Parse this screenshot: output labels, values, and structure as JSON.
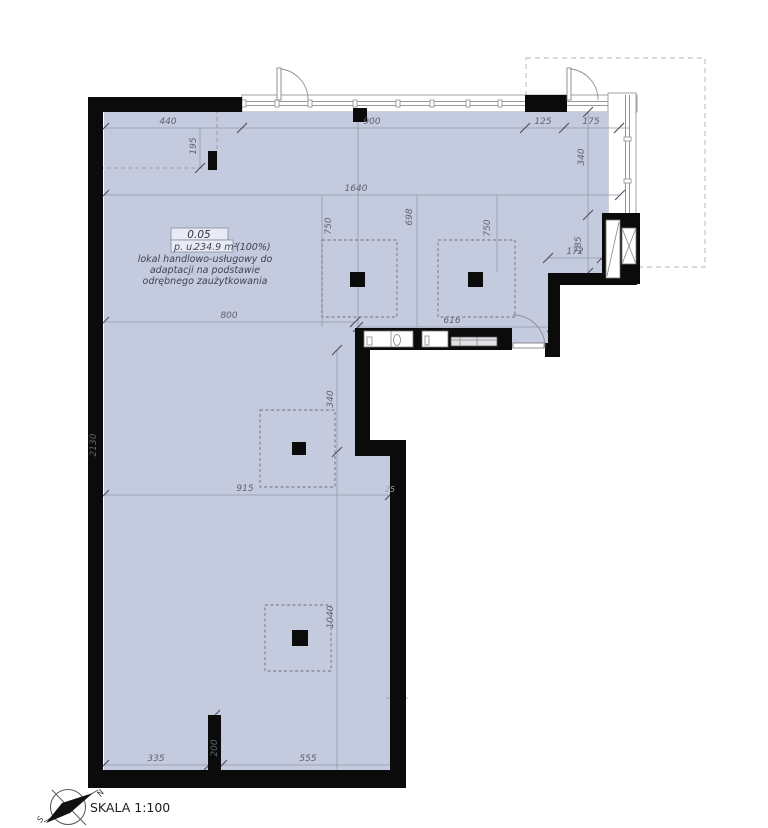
{
  "meta": {
    "scale_label": "SKALA 1:100"
  },
  "compass": {
    "north_label": "N",
    "south_label": "S"
  },
  "room_label": {
    "number": "0.05",
    "area_prefix": "p. u.",
    "area_value": "234.9 m²",
    "area_percent": "(100%)",
    "description_lines": [
      "lokal handlowo-usługowy do",
      "adaptacji na podstawie",
      "odrębnego zaużytkowania"
    ]
  },
  "dimensions": {
    "d440": "440",
    "d900": "900",
    "d125": "125",
    "d175": "175",
    "d195": "195",
    "d1640": "1640",
    "d750a": "750",
    "d698": "698",
    "d750b": "750",
    "d340r": "340",
    "d185": "185",
    "d172": "172",
    "d800": "800",
    "d616": "616",
    "d2130": "2130",
    "d340m": "340",
    "d915": "915",
    "d25": "25",
    "d1040": "1040",
    "d335": "335",
    "d555": "555",
    "d200": "200"
  },
  "colors": {
    "floor_fill": "#c5cbdf",
    "wall": "#0b0b0b",
    "dimension_line": "#9099aa"
  }
}
